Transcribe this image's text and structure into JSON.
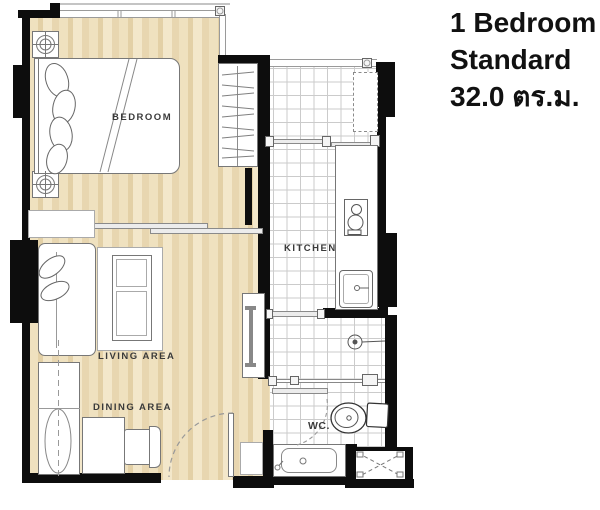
{
  "title": {
    "line1": "1 Bedroom",
    "line2": "Standard",
    "line3": "32.0 ตร.ม."
  },
  "rooms": {
    "bedroom": "BEDROOM",
    "kitchen": "KITCHEN",
    "living": "LIVING  AREA",
    "dining": "DINING  AREA",
    "wc": "WC."
  },
  "colors": {
    "wall": "#0d0d0d",
    "wood_light": "#f3e7ca",
    "wood_mid": "#e8d6b0",
    "wood_dark": "#e3d0a6",
    "tile_grid": "#cbcbcb",
    "furniture_outline": "#777777",
    "label_text": "#3a3a3a",
    "title_text": "#111111"
  }
}
